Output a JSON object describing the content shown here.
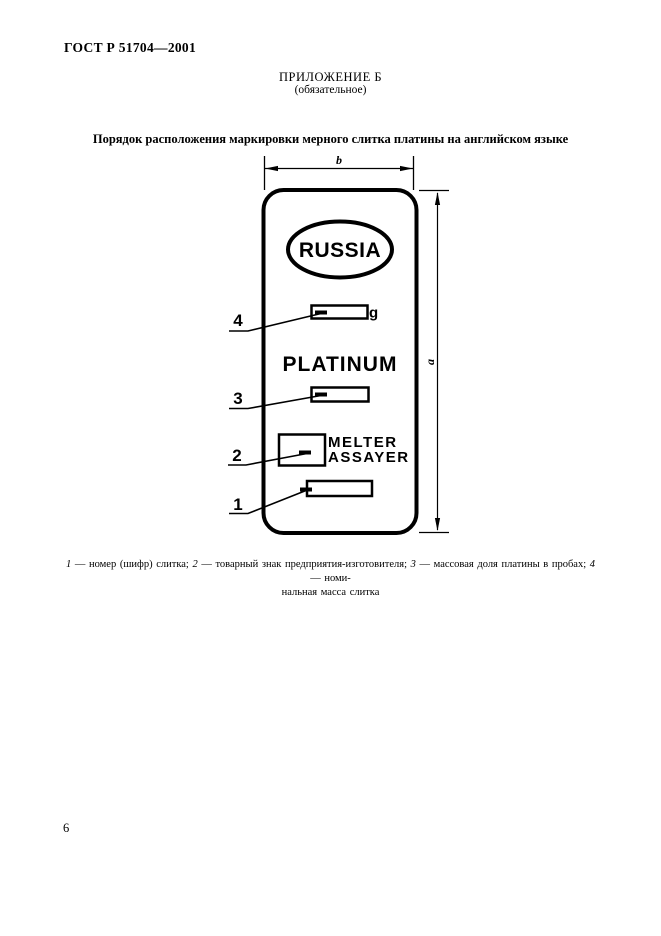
{
  "header": {
    "doc_number": "ГОСТ Р 51704—2001",
    "appendix": "ПРИЛОЖЕНИЕ Б",
    "appendix_note": "(обязательное)",
    "figure_title": "Порядок расположения маркировки мерного слитка платины на английском языке"
  },
  "diagram": {
    "width_dim_label": "b",
    "height_dim_label": "a",
    "stamp_country": "RUSSIA",
    "metal_name": "PLATINUM",
    "mass_unit": "g",
    "melter_label": "MELTER",
    "assayer_label": "ASSAYER",
    "callout_1": "1",
    "callout_2": "2",
    "callout_3": "3",
    "callout_4": "4"
  },
  "caption": {
    "item1_num": "1",
    "item1_text": " — номер (шифр) слитка; ",
    "item2_num": "2",
    "item2_text": " — товарный знак предприятия-изготовителя; ",
    "item3_num": "3",
    "item3_text": " — массовая доля платины в пробах; ",
    "item4_num": "4",
    "item4_text": " — номи-",
    "line2": "нальная масса слитка"
  },
  "footer": {
    "page_number": "6"
  }
}
